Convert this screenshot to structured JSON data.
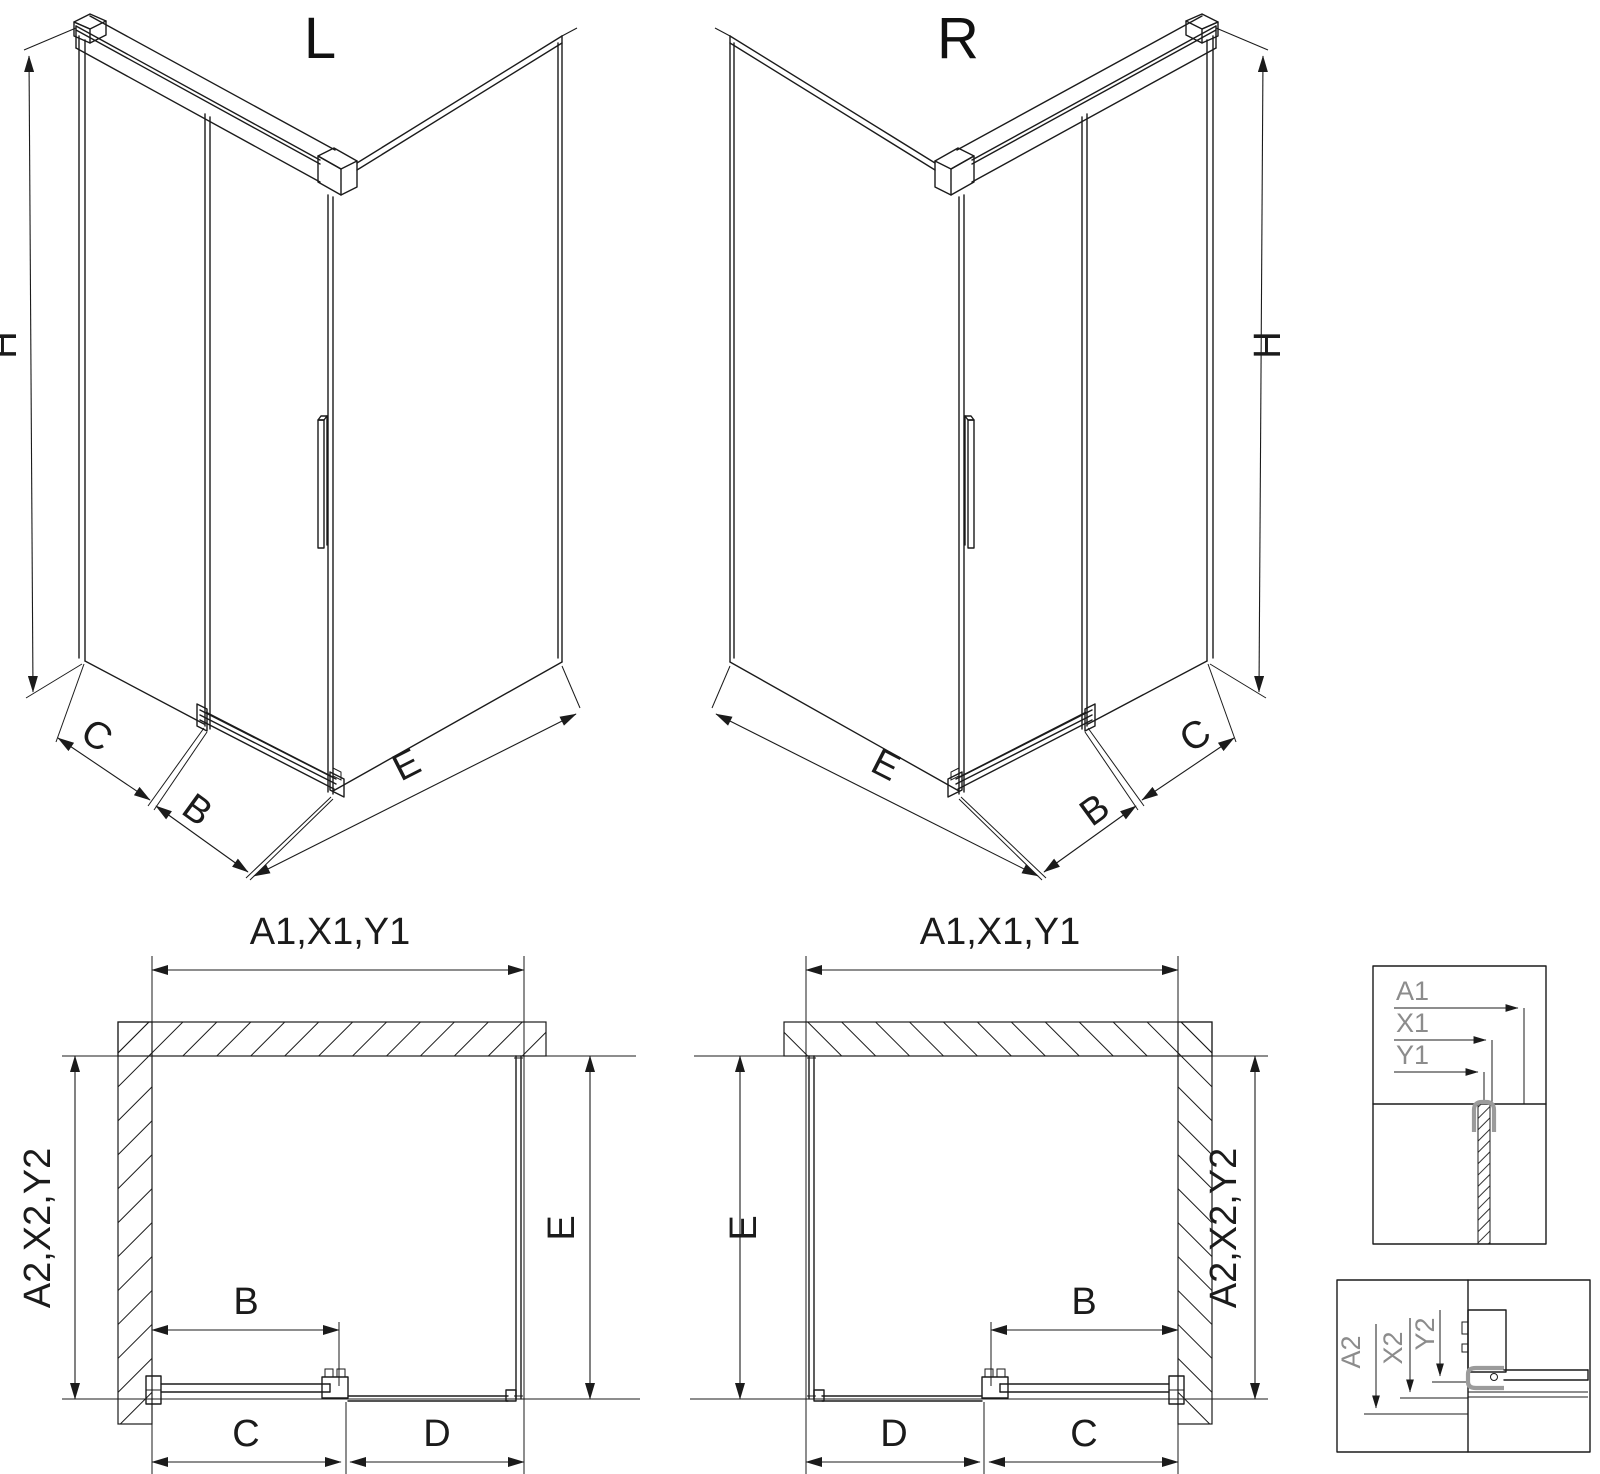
{
  "colors": {
    "line": "#1b1b1b",
    "detail_text": "#8c8c8c",
    "profile_gray": "#9b9b9b",
    "background": "#ffffff"
  },
  "iso_left": {
    "title": "L",
    "dim_height": "H",
    "dim_side_panel": "C",
    "dim_door": "B",
    "dim_fixed_wall": "E"
  },
  "iso_right": {
    "title": "R",
    "dim_height": "H",
    "dim_side_panel": "C",
    "dim_door": "B",
    "dim_fixed_wall": "E"
  },
  "plan_left": {
    "dim_top": "A1,X1,Y1",
    "dim_left": "A2,X2,Y2",
    "dim_right": "E",
    "dim_door": "B",
    "dim_bottom_inner": "C",
    "dim_bottom_outer": "D"
  },
  "plan_right": {
    "dim_top": "A1,X1,Y1",
    "dim_right": "A2,X2,Y2",
    "dim_left": "E",
    "dim_door": "B",
    "dim_bottom_inner": "C",
    "dim_bottom_outer": "D"
  },
  "detail_top_section": {
    "label_a1": "A1",
    "label_x1": "X1",
    "label_y1": "Y1"
  },
  "detail_bottom_section": {
    "label_a2": "A2",
    "label_x2": "X2",
    "label_y2": "Y2"
  }
}
